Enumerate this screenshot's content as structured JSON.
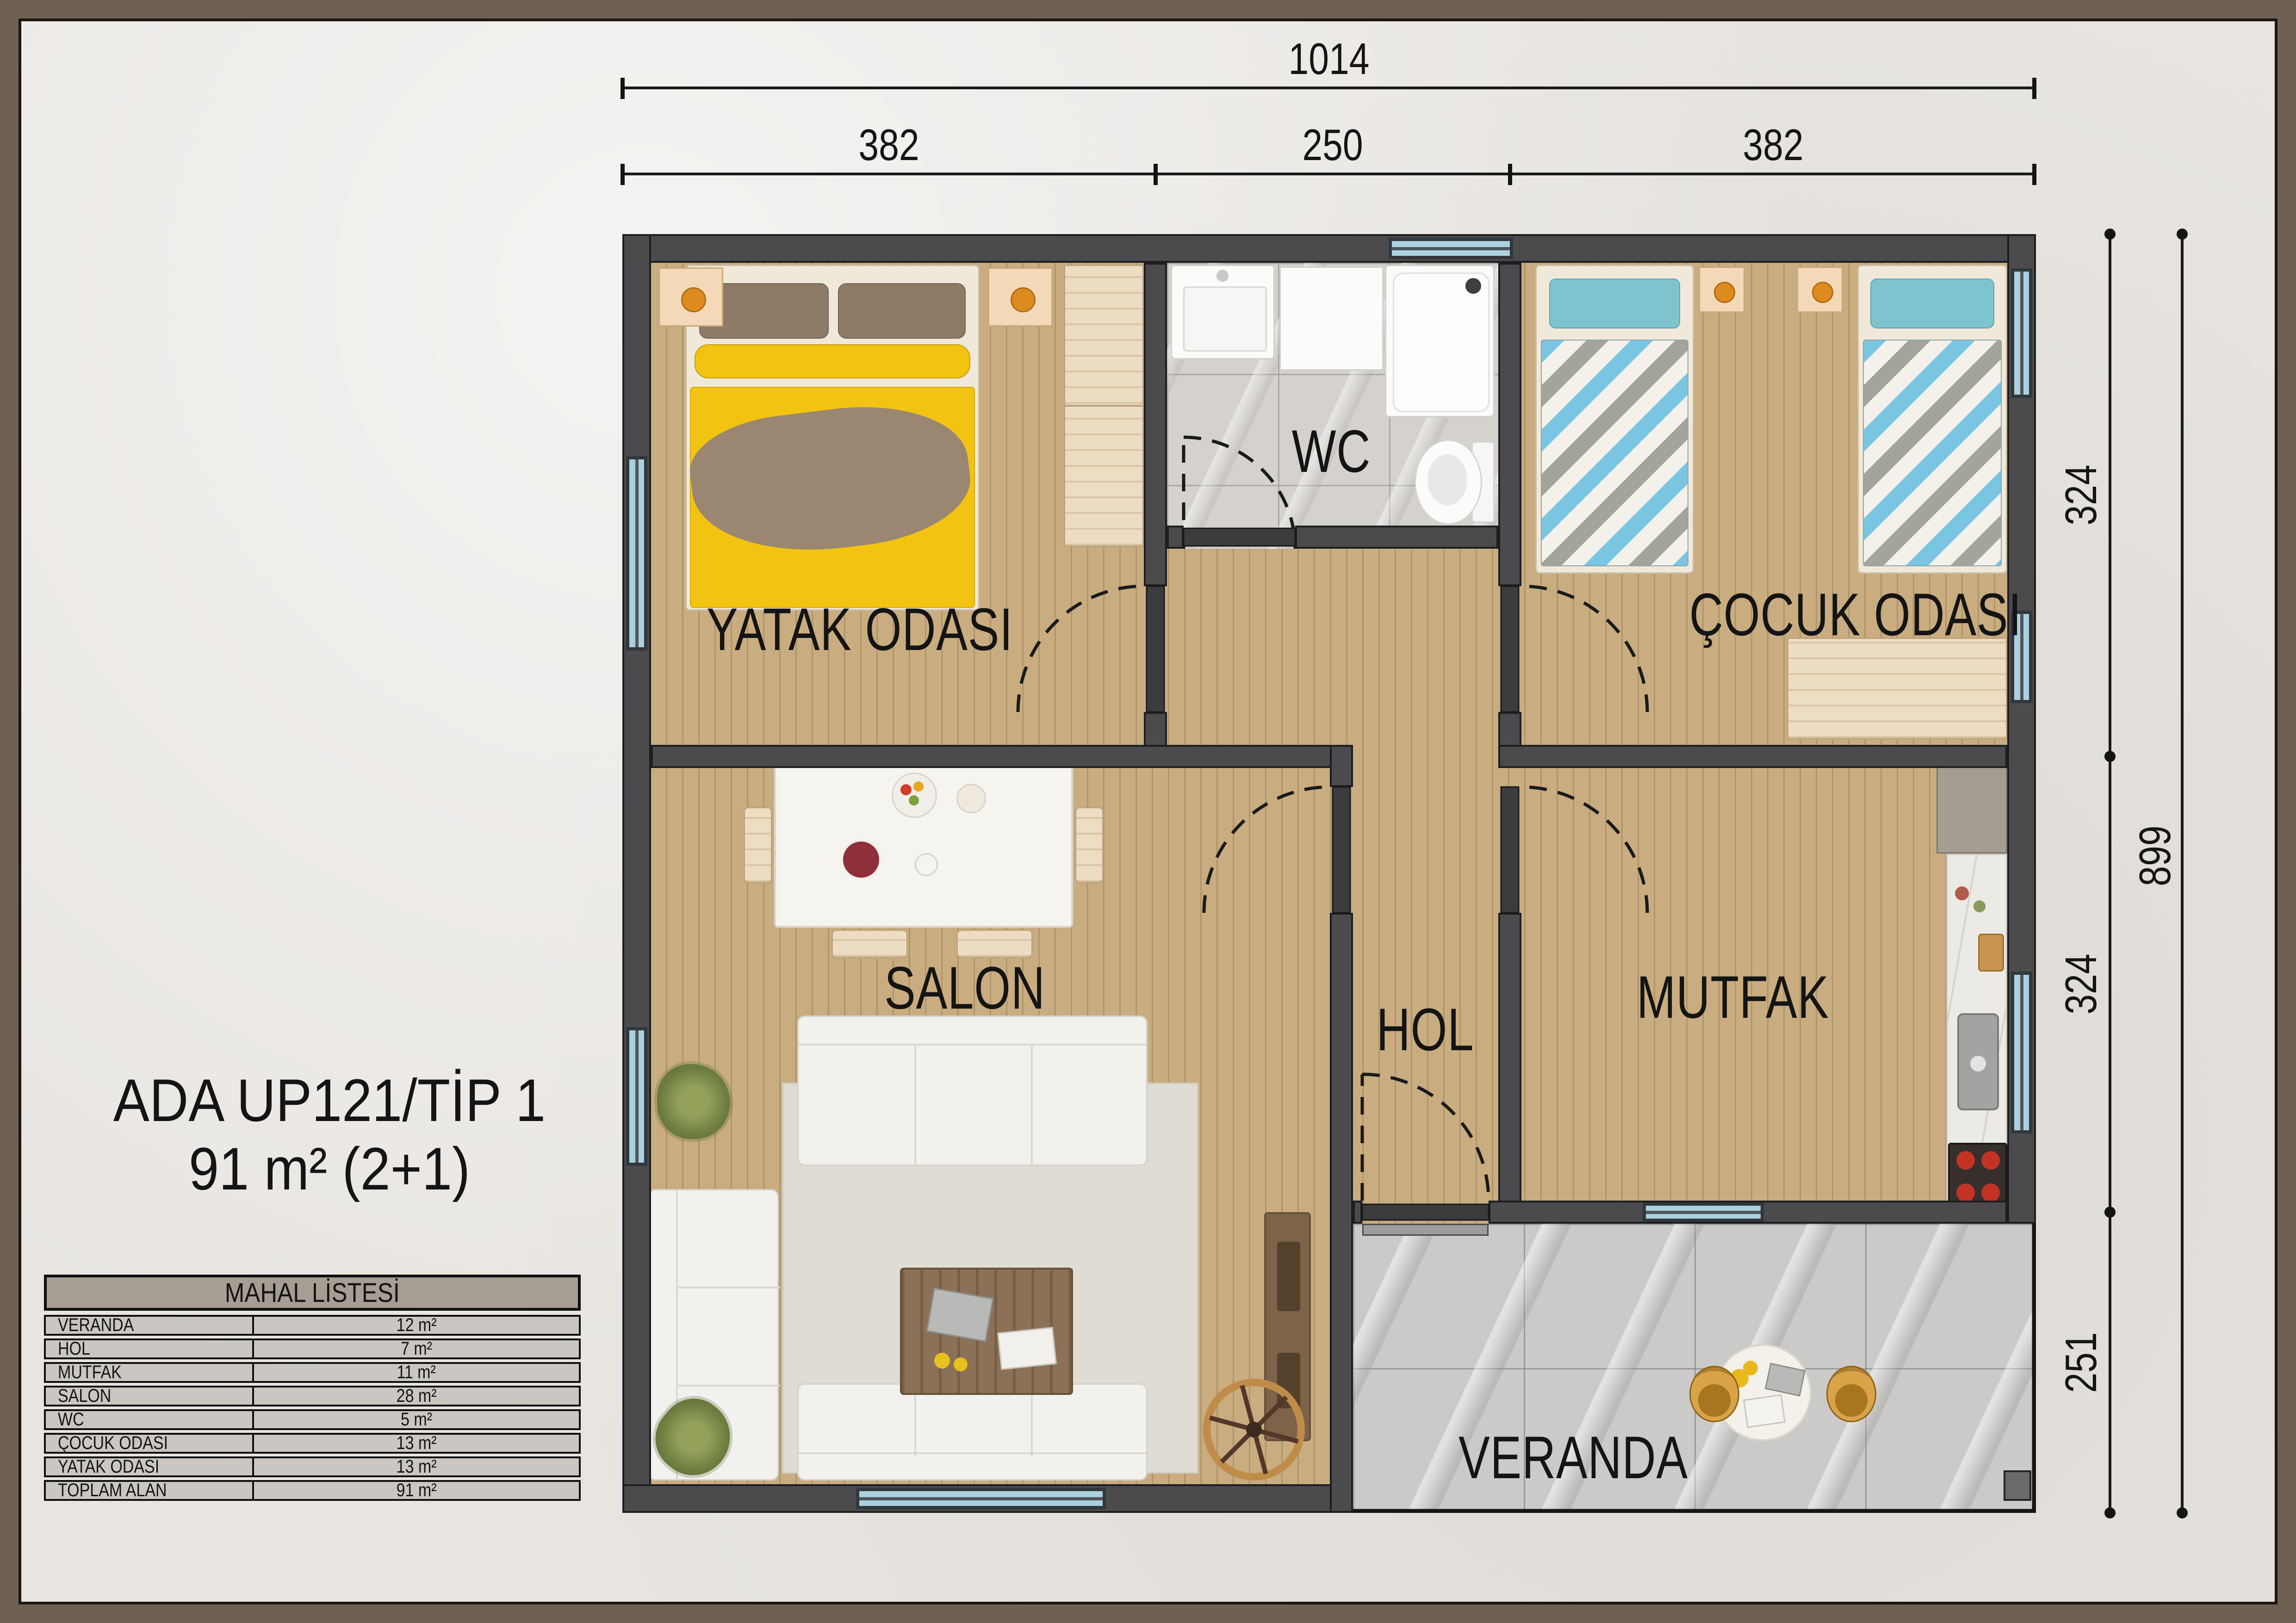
{
  "title": {
    "line1": "ADA UP121/TİP 1",
    "line2": "91 m² (2+1)"
  },
  "rooms": [
    {
      "id": "yatak-odasi",
      "label": "YATAK ODASI"
    },
    {
      "id": "wc",
      "label": "WC"
    },
    {
      "id": "cocuk-odasi",
      "label": "ÇOCUK ODASI"
    },
    {
      "id": "salon",
      "label": "SALON"
    },
    {
      "id": "hol",
      "label": "HOL"
    },
    {
      "id": "mutfak",
      "label": "MUTFAK"
    },
    {
      "id": "veranda",
      "label": "VERANDA"
    }
  ],
  "dimensions": {
    "top_total": "1014",
    "top_segments": [
      "382",
      "250",
      "382"
    ],
    "right_segments": [
      "324",
      "324",
      "251"
    ],
    "right_total": "899"
  },
  "mahal_listesi": {
    "title": "MAHAL LİSTESİ",
    "rows": [
      {
        "name": "VERANDA",
        "area": "12 m²"
      },
      {
        "name": "HOL",
        "area": "7 m²"
      },
      {
        "name": "MUTFAK",
        "area": "11 m²"
      },
      {
        "name": "SALON",
        "area": "28 m²"
      },
      {
        "name": "WC",
        "area": "5 m²"
      },
      {
        "name": "ÇOCUK ODASI",
        "area": "13 m²"
      },
      {
        "name": "YATAK ODASI",
        "area": "13 m²"
      },
      {
        "name": "TOPLAM ALAN",
        "area": "91 m²"
      }
    ]
  },
  "colors": {
    "frame": "#6f6152",
    "background": "#e8e5e1",
    "wall": "#4b4b4d",
    "wood_floor": "#cbb083",
    "marble_floor": "#d5d2ce",
    "veranda_floor": "#cbcac8",
    "window_glass": "#abd0e0",
    "bed_yellow": "#f2c411",
    "bed_teal": "#79c5e2",
    "text": "#141414"
  }
}
